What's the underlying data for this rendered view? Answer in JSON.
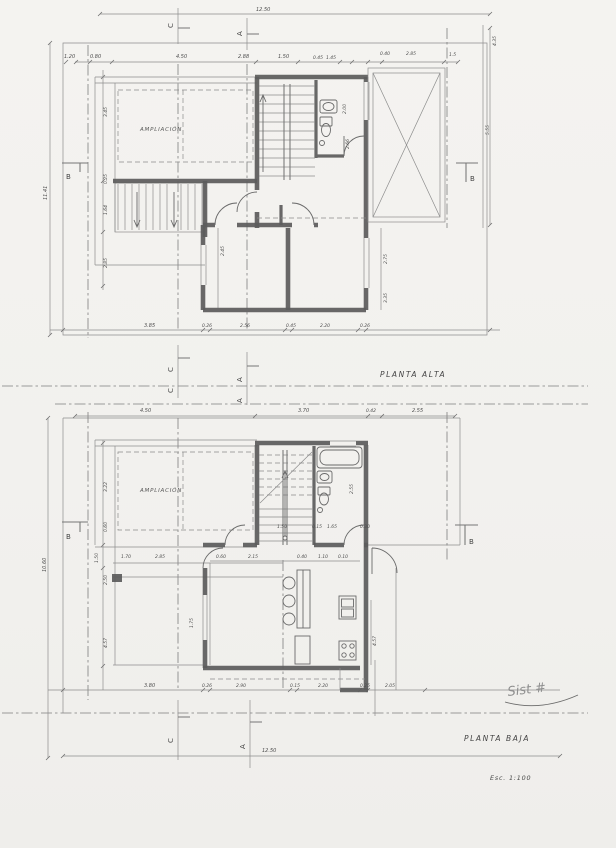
{
  "sheet": {
    "scale_label": "Esc. 1:100",
    "signature_text": "Sist #"
  },
  "plan_alta": {
    "title": "PLANTA ALTA",
    "room_label": "AMPLIACIÓN",
    "overall_width_top": "12.50",
    "overall_height_left": "11.41",
    "dims_top": [
      "1.20",
      "0.80",
      "4.50",
      "2.88",
      "1.50",
      "0.45",
      "1.45",
      "0.40",
      "2.85",
      "1.5"
    ],
    "dims_bottom": [
      "3.85",
      "0.26",
      "2.56",
      "0.45",
      "2.20",
      "0.26"
    ],
    "dims_left": [
      "3.45",
      "0.25",
      "1.64",
      "2.85"
    ],
    "dims_right": [
      "4.35",
      "5.55",
      "2.75",
      "3.35"
    ],
    "dims_inner": [
      "2.45",
      "2.00",
      "2.66"
    ],
    "markers": {
      "section_c": "C",
      "section_a": "A",
      "section_b": "B"
    }
  },
  "plan_baja": {
    "title": "PLANTA BAJA",
    "room_label": "AMPLIACIÓN",
    "overall_width_bottom": "12.50",
    "overall_height_left": "10.60",
    "dims_top": [
      "4.50",
      "3.70",
      "0.42",
      "2.55"
    ],
    "dims_bottom": [
      "3.80",
      "0.26",
      "2.90",
      "0.15",
      "2.20",
      "0.25",
      "2.05"
    ],
    "dims_left": [
      "3.22",
      "0.60",
      "1.50",
      "2.50",
      "4.57"
    ],
    "dims_inner_upper_row": [
      "1.50",
      "0.15",
      "1.65",
      "0.30"
    ],
    "dims_inner_lower_row": [
      "0.60",
      "2.15",
      "0.40",
      "1.10",
      "0.10"
    ],
    "dims_inner_misc": [
      "1.70",
      "2.85",
      "2.55",
      "1.75",
      "4.57"
    ],
    "markers": {
      "section_c": "C",
      "section_a": "A",
      "section_b": "B"
    }
  }
}
